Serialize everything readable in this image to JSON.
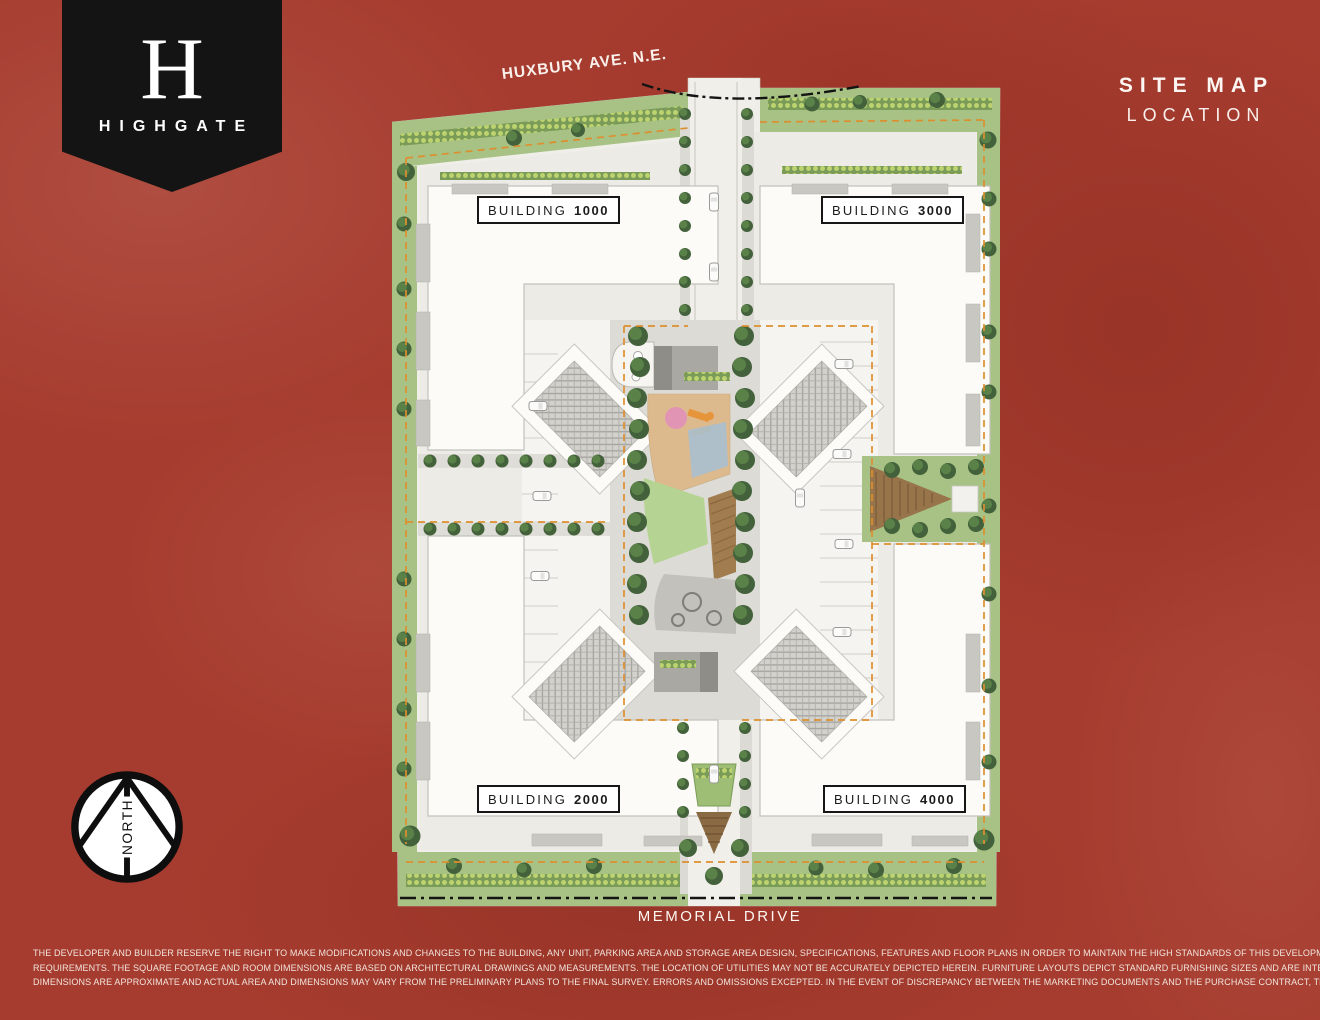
{
  "brand": {
    "monogram": "H",
    "wordmark": "HIGHGATE"
  },
  "titleBlock": {
    "line1": "SITE MAP",
    "line2": "LOCATION"
  },
  "map": {
    "streetTop": "HUXBURY AVE. N.E.",
    "streetBottom": "MEMORIAL DRIVE",
    "buildings": [
      {
        "name": "BUILDING",
        "number": "1000"
      },
      {
        "name": "BUILDING",
        "number": "3000"
      },
      {
        "name": "BUILDING",
        "number": "2000"
      },
      {
        "name": "BUILDING",
        "number": "4000"
      }
    ]
  },
  "compass": {
    "label": "NORTH"
  },
  "disclaimer": {
    "lines": [
      "THE DEVELOPER AND BUILDER RESERVE THE RIGHT TO MAKE MODIFICATIONS AND CHANGES TO THE BUILDING, ANY UNIT, PARKING AREA AND STORAGE AREA DESIGN, SPECIFICATIONS, FEATURES AND FLOOR PLANS IN ORDER TO MAINTAIN THE HIGH STANDARDS OF THIS DEVELOPMENT OR TO COMPLY WITH MUNICIPAL",
      "REQUIREMENTS. THE SQUARE FOOTAGE AND ROOM DIMENSIONS ARE BASED ON ARCHITECTURAL DRAWINGS AND MEASUREMENTS. THE LOCATION OF UTILITIES MAY NOT BE ACCURATELY DEPICTED HEREIN. FURNITURE LAYOUTS DEPICT STANDARD FURNISHING SIZES AND ARE INTENDED FOR REFERENCE ONLY. ALL SIZES AND",
      "DIMENSIONS ARE APPROXIMATE AND ACTUAL AREA AND DIMENSIONS MAY VARY FROM THE PRELIMINARY PLANS TO THE FINAL SURVEY. ERRORS AND OMISSIONS EXCEPTED. IN THE EVENT OF DISCREPANCY BETWEEN THE MARKETING DOCUMENTS AND THE PURCHASE CONTRACT, THE PURCHASE CONTRACT WILL PREVAIL."
    ]
  },
  "colors": {
    "background": "#A63C2F",
    "banner": "#141414",
    "propertyLine": "#DD8F2F",
    "lawn": "#A7C284",
    "tree": "#43613B",
    "building": "#FCFBF8"
  }
}
